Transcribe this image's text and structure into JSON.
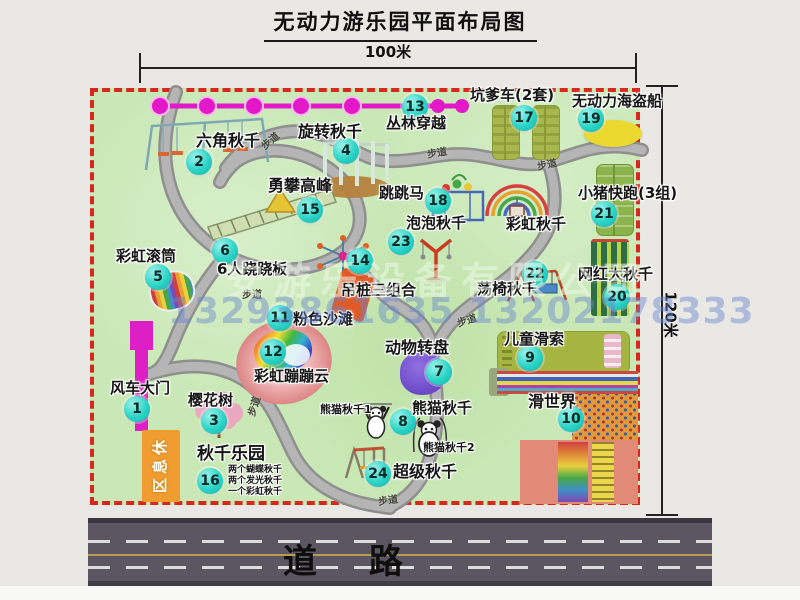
{
  "title": "无动力游乐园平面布局图",
  "dim_top": "100米",
  "dim_right": "120米",
  "road_label": "道　 路",
  "rest_area": "休息区",
  "watermark": {
    "company": "安游乐设备有限公司",
    "phone": "13293861635 13202178333"
  },
  "colors": {
    "map_bg": "#c9e8b6",
    "map_border": "#d8281e",
    "badge": "#2bd4c7",
    "path_gray": "#a7a7a7",
    "road": "#5b5662",
    "zipline_magenta": "#e318c8",
    "gate_magenta": "#df1fc6",
    "rest_area_orange": "#f09c30"
  },
  "attractions": [
    {
      "num": "1",
      "name": "风车大门",
      "bx": 137,
      "by": 409,
      "lx": 110,
      "ly": 381,
      "fs": 15
    },
    {
      "num": "2",
      "name": "六角秋千",
      "bx": 199,
      "by": 162,
      "lx": 196,
      "ly": 133,
      "fs": 16
    },
    {
      "num": "3",
      "name": "樱花树",
      "bx": 214,
      "by": 421,
      "lx": 188,
      "ly": 393,
      "fs": 15
    },
    {
      "num": "4",
      "name": "旋转秋千",
      "bx": 346,
      "by": 151,
      "lx": 298,
      "ly": 124,
      "fs": 16
    },
    {
      "num": "5",
      "name": "彩虹滚筒",
      "bx": 158,
      "by": 277,
      "lx": 116,
      "ly": 249,
      "fs": 15
    },
    {
      "num": "6",
      "name": "6人跷跷板",
      "bx": 225,
      "by": 251,
      "lx": 217,
      "ly": 262,
      "fs": 15
    },
    {
      "num": "7",
      "name": "动物转盘",
      "bx": 439,
      "by": 372,
      "lx": 385,
      "ly": 340,
      "fs": 16
    },
    {
      "num": "8",
      "name": "熊猫秋千",
      "bx": 403,
      "by": 422,
      "lx": 412,
      "ly": 401,
      "fs": 15
    },
    {
      "num": "9",
      "name": "儿童滑索",
      "bx": 530,
      "by": 358,
      "lx": 504,
      "ly": 332,
      "fs": 15
    },
    {
      "num": "10",
      "name": "滑世界",
      "bx": 571,
      "by": 419,
      "lx": 528,
      "ly": 394,
      "fs": 16
    },
    {
      "num": "11",
      "name": "粉色沙滩",
      "bx": 280,
      "by": 318,
      "lx": 293,
      "ly": 312,
      "fs": 15
    },
    {
      "num": "12",
      "name": "彩虹蹦蹦云",
      "bx": 273,
      "by": 352,
      "lx": 254,
      "ly": 369,
      "fs": 15
    },
    {
      "num": "13",
      "name": "丛林穿越",
      "bx": 415,
      "by": 107,
      "lx": 386,
      "ly": 116,
      "fs": 15
    },
    {
      "num": "14",
      "name": "吊桩三组合",
      "bx": 360,
      "by": 261,
      "lx": 341,
      "ly": 283,
      "fs": 15
    },
    {
      "num": "15",
      "name": "勇攀高峰",
      "bx": 310,
      "by": 210,
      "lx": 268,
      "ly": 178,
      "fs": 16
    },
    {
      "num": "16",
      "name": "秋千乐园",
      "bx": 210,
      "by": 481,
      "lx": 197,
      "ly": 446,
      "fs": 17
    },
    {
      "num": "17",
      "name": "坑爹车(2套)",
      "bx": 524,
      "by": 118,
      "lx": 470,
      "ly": 88,
      "fs": 15
    },
    {
      "num": "18",
      "name": "跳跳马",
      "bx": 438,
      "by": 201,
      "lx": 379,
      "ly": 186,
      "fs": 15
    },
    {
      "num": "19",
      "name": "无动力海盗船",
      "bx": 591,
      "by": 119,
      "lx": 572,
      "ly": 94,
      "fs": 15
    },
    {
      "num": "20",
      "name": "网红大秋千",
      "bx": 617,
      "by": 297,
      "lx": 578,
      "ly": 267,
      "fs": 15
    },
    {
      "num": "21",
      "name": "小猪快跑(3组)",
      "bx": 604,
      "by": 214,
      "lx": 578,
      "ly": 186,
      "fs": 15
    },
    {
      "num": "22",
      "name": "荡椅秋千",
      "bx": 535,
      "by": 274,
      "lx": 477,
      "ly": 282,
      "fs": 15
    },
    {
      "num": "23",
      "name": "泡泡秋千",
      "bx": 401,
      "by": 242,
      "lx": 406,
      "ly": 216,
      "fs": 15
    },
    {
      "num": "24",
      "name": "超级秋千",
      "bx": 378,
      "by": 474,
      "lx": 393,
      "ly": 464,
      "fs": 16
    }
  ],
  "annotations": [
    {
      "text": "彩虹秋千",
      "x": 506,
      "y": 217,
      "fs": 15
    },
    {
      "text": "熊猫秋千1",
      "x": 320,
      "y": 404,
      "fs": 11
    },
    {
      "text": "熊猫秋千2",
      "x": 423,
      "y": 442,
      "fs": 11
    },
    {
      "text": "两个蝴蝶秋千",
      "x": 228,
      "y": 466,
      "fs": 9
    },
    {
      "text": "两个发光秋千",
      "x": 228,
      "y": 477,
      "fs": 9
    },
    {
      "text": "一个彩虹秋千",
      "x": 228,
      "y": 488,
      "fs": 9
    }
  ],
  "trail_labels": [
    {
      "text": "步道",
      "x": 262,
      "y": 139,
      "rot": -40
    },
    {
      "text": "步道",
      "x": 427,
      "y": 146,
      "rot": -10
    },
    {
      "text": "步道",
      "x": 537,
      "y": 158,
      "rot": -12
    },
    {
      "text": "步道",
      "x": 242,
      "y": 286,
      "rot": 0
    },
    {
      "text": "步道",
      "x": 250,
      "y": 408,
      "rot": -72
    },
    {
      "text": "步道",
      "x": 378,
      "y": 493,
      "rot": -8
    },
    {
      "text": "步道",
      "x": 457,
      "y": 315,
      "rot": -18
    }
  ]
}
